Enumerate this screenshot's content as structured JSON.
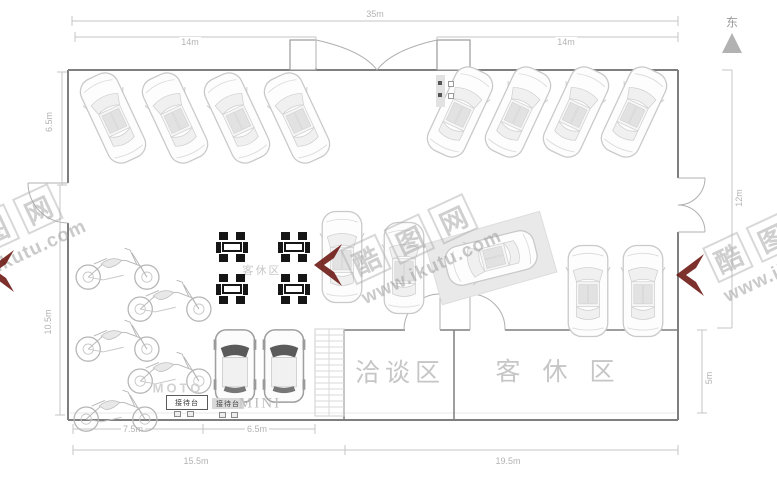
{
  "compass": {
    "label": "东"
  },
  "dimensions": {
    "top_total": "35m",
    "top_left": "14m",
    "top_right": "14m",
    "left_upper": "6.5m",
    "left_lower": "10.5m",
    "right_upper": "12m",
    "right_lower": "5m",
    "bottom_moto": "7.5m",
    "bottom_mini": "6.5m",
    "bottom_left": "15.5m",
    "bottom_right": "19.5m"
  },
  "labels": {
    "negotiation_room": "洽谈区",
    "lounge_room": "客休区",
    "lounge_seating": "客休区",
    "moto": "MOTO",
    "mini": "MINI",
    "desk": "接待台"
  },
  "watermark": {
    "chars": [
      "酷",
      "图",
      "网"
    ],
    "url": "www.ikutu.com",
    "color": "#6e1b16"
  }
}
